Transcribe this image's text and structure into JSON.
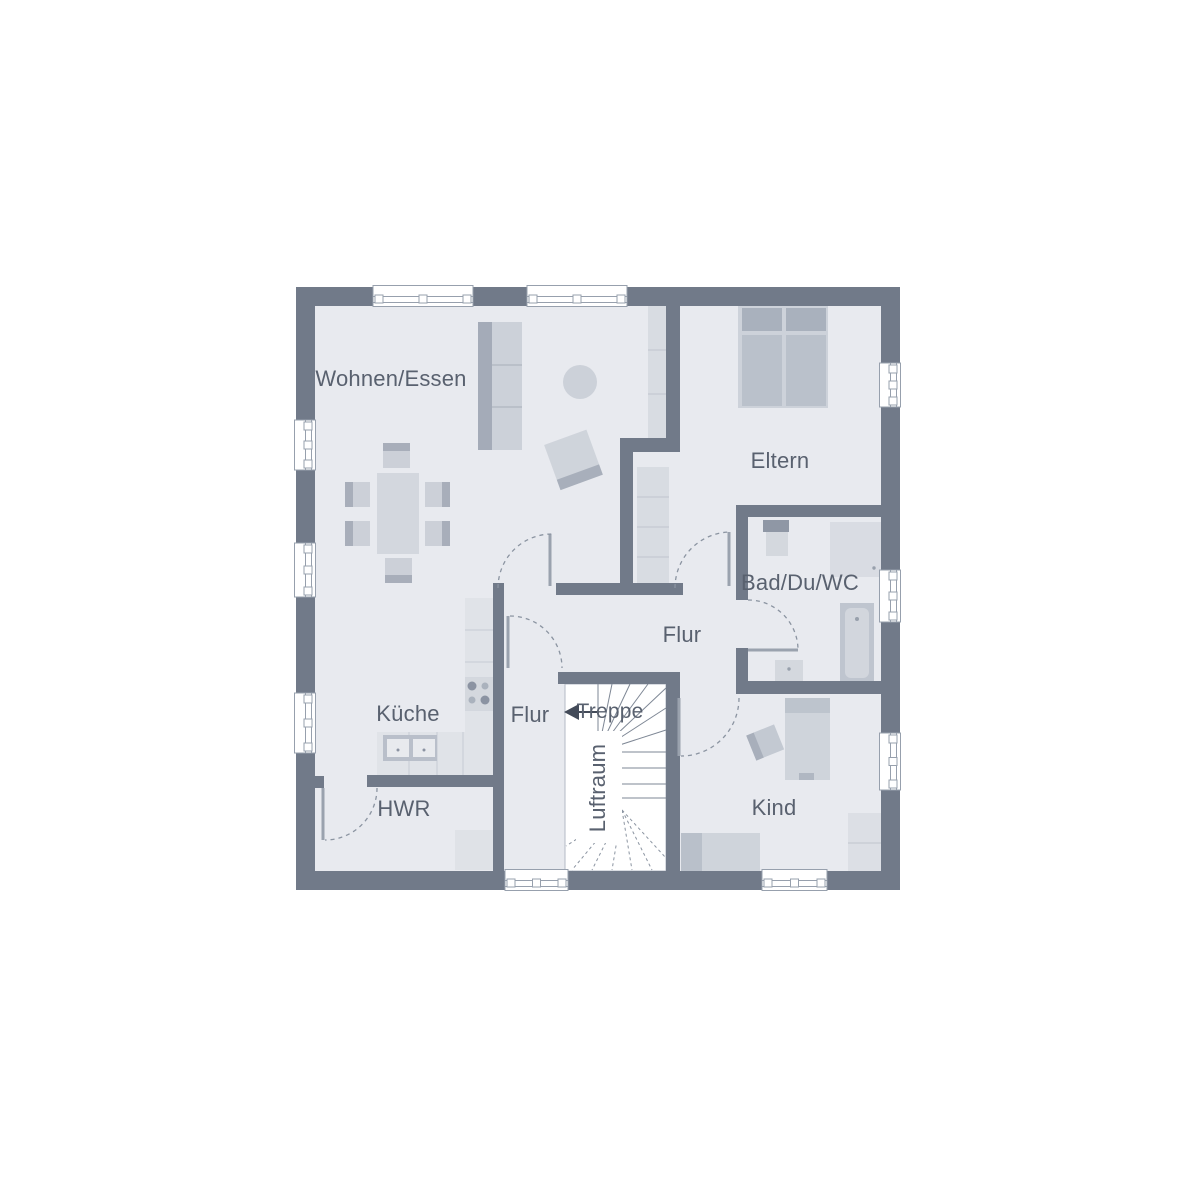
{
  "rooms": {
    "wohnen_essen": {
      "label": "Wohnen/Essen"
    },
    "eltern": {
      "label": "Eltern"
    },
    "bad_du_wc": {
      "label": "Bad/Du/WC"
    },
    "flur": {
      "label": "Flur"
    },
    "flur_klein": {
      "label": "Flur"
    },
    "kueche": {
      "label": "Küche"
    },
    "treppe": {
      "label": "Treppe"
    },
    "luftraum": {
      "label": "Luftraum"
    },
    "hwr": {
      "label": "HWR"
    },
    "kind": {
      "label": "Kind"
    }
  },
  "colors": {
    "wall": "#717a89",
    "floor": "#e8eaef",
    "stairwell": "#ffffff",
    "furniture_light": "#d3d8de",
    "furniture_mid": "#bcc3cc",
    "furniture_dark": "#a8afbb",
    "fixture_light": "#dfe2e7",
    "label_text": "#59616f",
    "door_arc": "#8b94a1",
    "window_frame": "#97a0ad",
    "stair_line": "#7e8795",
    "arrow": "#434b59"
  },
  "furniture": [
    "sideboard",
    "round-rug",
    "armchair",
    "dining-table",
    "dining-chair",
    "wardrobe",
    "double-bed",
    "sink",
    "shower",
    "bathtub",
    "wc",
    "kitchen-counter",
    "stove",
    "kitchen-sink",
    "washing-machine",
    "child-bed",
    "single-bed",
    "desk",
    "closet"
  ]
}
